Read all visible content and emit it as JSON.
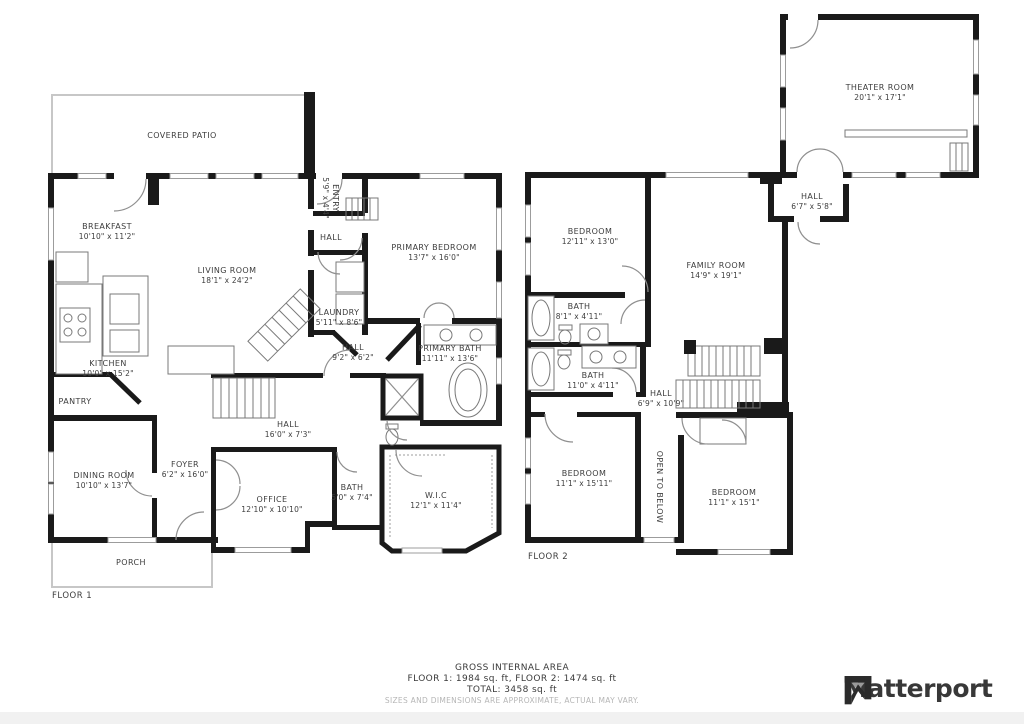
{
  "colors": {
    "wall": "#1a1a1a",
    "thin_line": "#787878",
    "light_outline": "#c7c7c7",
    "label_text": "#3d3d3d",
    "disclaimer_text": "#b6b6b6",
    "brand_text": "#383838",
    "bottom_band": "#f1f1f1"
  },
  "floor1": {
    "label": "FLOOR 1",
    "rooms": [
      {
        "name": "COVERED PATIO",
        "dims": ""
      },
      {
        "name": "BREAKFAST",
        "dims": "10'10\" x 11'2\""
      },
      {
        "name": "LIVING ROOM",
        "dims": "18'1\" x 24'2\""
      },
      {
        "name": "ENTRY",
        "dims": "5'9\" x 4'4\""
      },
      {
        "name": "HALL",
        "dims": ""
      },
      {
        "name": "PRIMARY BEDROOM",
        "dims": "13'7\" x 16'0\""
      },
      {
        "name": "LAUNDRY",
        "dims": "5'11\" x 8'6\""
      },
      {
        "name": "KITCHEN",
        "dims": "10'0\" x 15'2\""
      },
      {
        "name": "PANTRY",
        "dims": ""
      },
      {
        "name": "HALL",
        "dims": "9'2\" x 6'2\""
      },
      {
        "name": "PRIMARY BATH",
        "dims": "11'11\" x 13'6\""
      },
      {
        "name": "HALL",
        "dims": "16'0\" x 7'3\""
      },
      {
        "name": "DINING ROOM",
        "dims": "10'10\" x 13'7\""
      },
      {
        "name": "FOYER",
        "dims": "6'2\" x 16'0\""
      },
      {
        "name": "OFFICE",
        "dims": "12'10\" x 10'10\""
      },
      {
        "name": "BATH",
        "dims": "5'0\" x 7'4\""
      },
      {
        "name": "W.I.C",
        "dims": "12'1\" x 11'4\""
      },
      {
        "name": "PORCH",
        "dims": ""
      }
    ]
  },
  "floor2": {
    "label": "FLOOR 2",
    "rooms": [
      {
        "name": "THEATER ROOM",
        "dims": "20'1\" x 17'1\""
      },
      {
        "name": "HALL",
        "dims": "6'7\" x 5'8\""
      },
      {
        "name": "BEDROOM",
        "dims": "12'11\" x 13'0\""
      },
      {
        "name": "FAMILY ROOM",
        "dims": "14'9\" x 19'1\""
      },
      {
        "name": "BATH",
        "dims": "8'1\" x 4'11\""
      },
      {
        "name": "BATH",
        "dims": "11'0\" x 4'11\""
      },
      {
        "name": "HALL",
        "dims": "6'9\" x 10'9\""
      },
      {
        "name": "BEDROOM",
        "dims": "11'1\" x 15'11\""
      },
      {
        "name": "BEDROOM",
        "dims": "11'1\" x 15'1\""
      },
      {
        "name": "OPEN TO BELOW",
        "dims": ""
      }
    ]
  },
  "footer": {
    "title": "GROSS INTERNAL AREA",
    "floors": "FLOOR 1: 1984 sq. ft, FLOOR 2: 1474 sq. ft",
    "total": "TOTAL: 3458 sq. ft",
    "disclaimer": "SIZES AND DIMENSIONS ARE APPROXIMATE, ACTUAL MAY VARY.",
    "brand": "Matterport"
  }
}
